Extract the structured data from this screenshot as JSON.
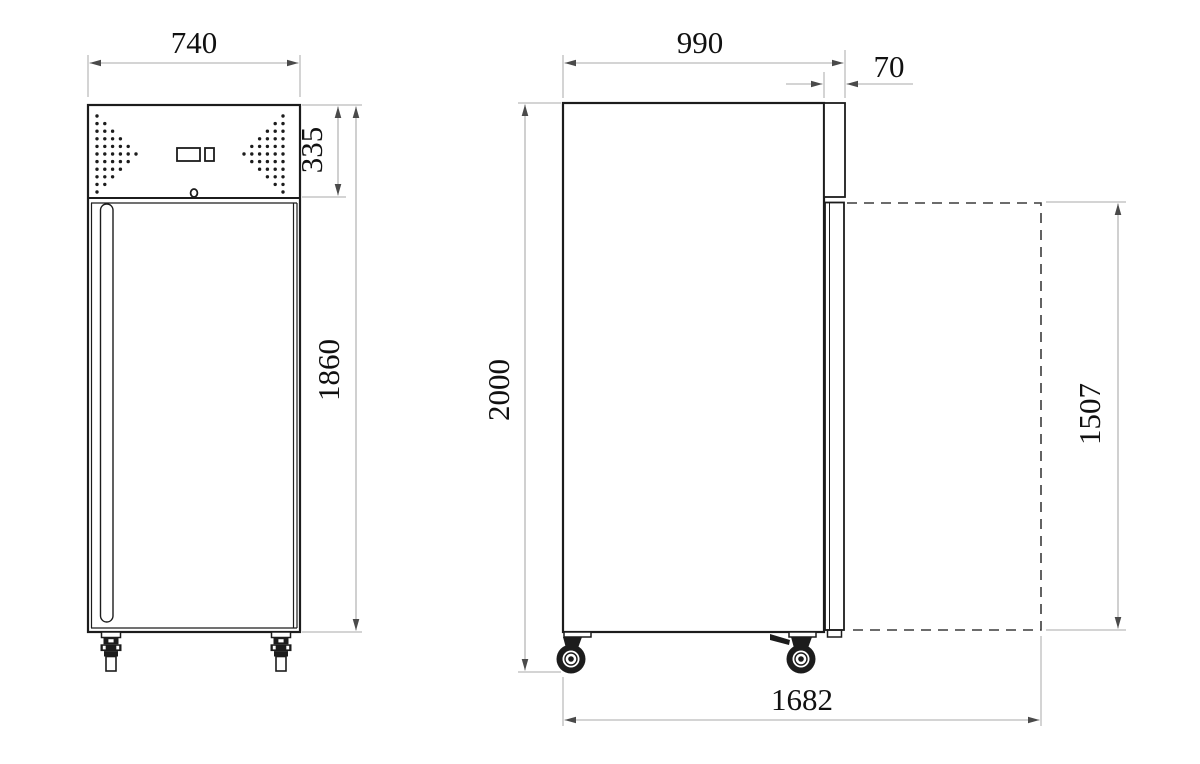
{
  "front_view": {
    "width_dim": "740",
    "top_panel_height_dim": "335",
    "cabinet_height_dim": "1860",
    "vent_rows": [
      1,
      2,
      3,
      4,
      5,
      6,
      5,
      4,
      3,
      2,
      1
    ]
  },
  "side_view": {
    "depth_dim": "990",
    "door_thickness_dim": "70",
    "overall_height_dim": "2000",
    "open_door_height_dim": "1507",
    "overall_depth_door_open_dim": "1682"
  },
  "colors": {
    "line": "#1c1c1c",
    "dimension_line": "#a9a9a9",
    "arrow": "#4a4a4a",
    "text": "#111111",
    "dashed_outline": "#3c3c3c",
    "background": "#ffffff"
  }
}
